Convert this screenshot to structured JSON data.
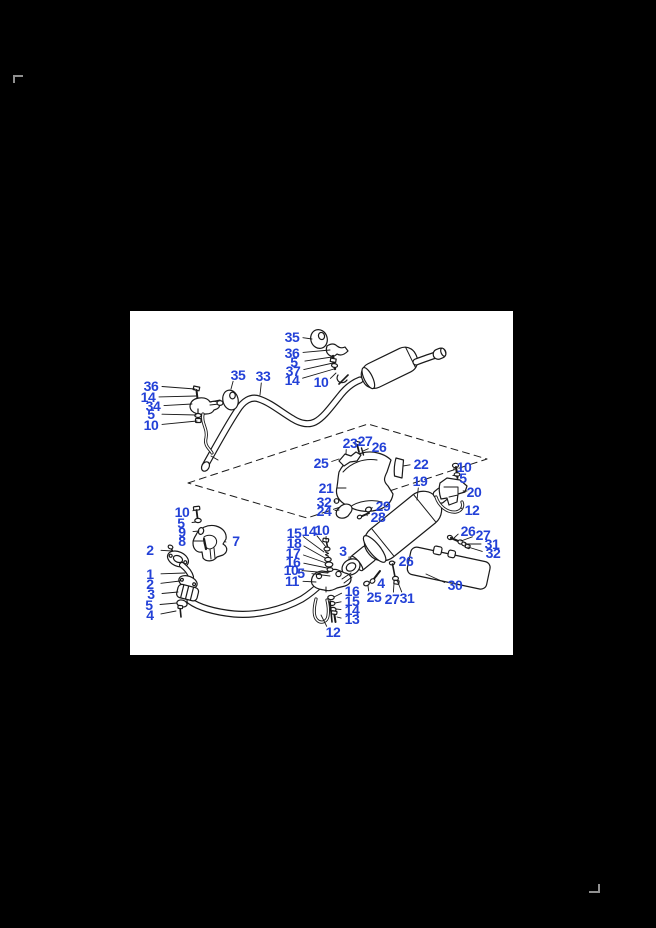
{
  "page": {
    "background_color": "#000000",
    "crop_mark_color": "#909090"
  },
  "panel": {
    "background_color": "#ffffff",
    "description_visible_text_only": "exploded parts diagram with numbered callouts"
  },
  "diagram": {
    "type": "exploded-parts-diagram",
    "line_color": "#1a1a1a",
    "label_color": "#2341d7",
    "callouts": [
      {
        "n": "35",
        "x": 162,
        "y": 26,
        "tx": 182,
        "ty": 28
      },
      {
        "n": "36",
        "x": 162,
        "y": 42,
        "tx": 200,
        "ty": 39
      },
      {
        "n": "5",
        "x": 164,
        "y": 51,
        "tx": 202,
        "ty": 46
      },
      {
        "n": "37",
        "x": 163,
        "y": 60,
        "tx": 203,
        "ty": 52
      },
      {
        "n": "14",
        "x": 162,
        "y": 69,
        "tx": 204,
        "ty": 58
      },
      {
        "n": "10",
        "x": 191,
        "y": 71,
        "tx": 206,
        "ty": 62
      },
      {
        "n": "35",
        "x": 108,
        "y": 64,
        "tx": 101,
        "ty": 78
      },
      {
        "n": "33",
        "x": 133,
        "y": 65,
        "tx": 130,
        "ty": 84
      },
      {
        "n": "36",
        "x": 21,
        "y": 75,
        "tx": 65,
        "ty": 78
      },
      {
        "n": "14",
        "x": 18,
        "y": 86,
        "tx": 66,
        "ty": 85
      },
      {
        "n": "34",
        "x": 23,
        "y": 95,
        "tx": 62,
        "ty": 93
      },
      {
        "n": "5",
        "x": 21,
        "y": 103,
        "tx": 66,
        "ty": 104
      },
      {
        "n": "10",
        "x": 21,
        "y": 114,
        "tx": 67,
        "ty": 110
      },
      {
        "n": "23",
        "x": 220,
        "y": 132,
        "tx": 216,
        "ty": 143
      },
      {
        "n": "27",
        "x": 235,
        "y": 130,
        "tx": 228,
        "ty": 135
      },
      {
        "n": "26",
        "x": 249,
        "y": 136,
        "tx": 233,
        "ty": 140
      },
      {
        "n": "25",
        "x": 191,
        "y": 152,
        "tx": 209,
        "ty": 148
      },
      {
        "n": "22",
        "x": 291,
        "y": 153,
        "tx": 273,
        "ty": 155
      },
      {
        "n": "10",
        "x": 334,
        "y": 156,
        "tx": 327,
        "ty": 158
      },
      {
        "n": "5",
        "x": 333,
        "y": 167,
        "tx": 328,
        "ty": 165
      },
      {
        "n": "21",
        "x": 196,
        "y": 177,
        "tx": 216,
        "ty": 177
      },
      {
        "n": "19",
        "x": 290,
        "y": 170,
        "tx": 287,
        "ty": 189
      },
      {
        "n": "20",
        "x": 344,
        "y": 181,
        "tx": 337,
        "ty": 180
      },
      {
        "n": "32",
        "x": 194,
        "y": 191,
        "tx": 205,
        "ty": 190
      },
      {
        "n": "24",
        "x": 194,
        "y": 200,
        "tx": 209,
        "ty": 199
      },
      {
        "n": "29",
        "x": 253,
        "y": 195,
        "tx": 241,
        "ty": 198
      },
      {
        "n": "28",
        "x": 248,
        "y": 206,
        "tx": 237,
        "ty": 204
      },
      {
        "n": "12",
        "x": 342,
        "y": 199,
        "tx": 332,
        "ty": 197
      },
      {
        "n": "10",
        "x": 52,
        "y": 201,
        "tx": 64,
        "ty": 199
      },
      {
        "n": "5",
        "x": 51,
        "y": 212,
        "tx": 66,
        "ty": 211
      },
      {
        "n": "9",
        "x": 52,
        "y": 221,
        "tx": 69,
        "ty": 220
      },
      {
        "n": "8",
        "x": 52,
        "y": 230,
        "tx": 73,
        "ty": 230
      },
      {
        "n": "7",
        "x": 106,
        "y": 230,
        "tx": 96,
        "ty": 231
      },
      {
        "n": "2",
        "x": 20,
        "y": 239,
        "tx": 42,
        "ty": 240
      },
      {
        "n": "1",
        "x": 20,
        "y": 263,
        "tx": 55,
        "ty": 262
      },
      {
        "n": "2",
        "x": 20,
        "y": 273,
        "tx": 50,
        "ty": 270
      },
      {
        "n": "3",
        "x": 21,
        "y": 283,
        "tx": 48,
        "ty": 281
      },
      {
        "n": "5",
        "x": 19,
        "y": 294,
        "tx": 47,
        "ty": 292
      },
      {
        "n": "4",
        "x": 20,
        "y": 304,
        "tx": 46,
        "ty": 300
      },
      {
        "n": "15",
        "x": 164,
        "y": 222,
        "tx": 194,
        "ty": 241
      },
      {
        "n": "14",
        "x": 179,
        "y": 220,
        "tx": 196,
        "ty": 236
      },
      {
        "n": "10",
        "x": 192,
        "y": 219,
        "tx": 196,
        "ty": 229
      },
      {
        "n": "18",
        "x": 164,
        "y": 232,
        "tx": 195,
        "ty": 247
      },
      {
        "n": "17",
        "x": 163,
        "y": 242,
        "tx": 196,
        "ty": 252
      },
      {
        "n": "16",
        "x": 163,
        "y": 251,
        "tx": 197,
        "ty": 257
      },
      {
        "n": "10",
        "x": 161,
        "y": 259,
        "tx": 198,
        "ty": 262
      },
      {
        "n": "5",
        "x": 171,
        "y": 262,
        "tx": 200,
        "ty": 265
      },
      {
        "n": "11",
        "x": 162,
        "y": 270,
        "tx": 186,
        "ty": 271
      },
      {
        "n": "3",
        "x": 213,
        "y": 240,
        "tx": 219,
        "ty": 249
      },
      {
        "n": "16",
        "x": 222,
        "y": 280,
        "tx": 204,
        "ty": 286
      },
      {
        "n": "15",
        "x": 222,
        "y": 290,
        "tx": 205,
        "ty": 292
      },
      {
        "n": "14",
        "x": 222,
        "y": 299,
        "tx": 206,
        "ty": 298
      },
      {
        "n": "13",
        "x": 222,
        "y": 308,
        "tx": 207,
        "ty": 306
      },
      {
        "n": "12",
        "x": 203,
        "y": 321,
        "tx": 191,
        "ty": 304
      },
      {
        "n": "4",
        "x": 251,
        "y": 272,
        "tx": 247,
        "ty": 265
      },
      {
        "n": "25",
        "x": 244,
        "y": 286,
        "tx": 238,
        "ty": 275
      },
      {
        "n": "27",
        "x": 262,
        "y": 288,
        "tx": 264,
        "ty": 272
      },
      {
        "n": "31",
        "x": 277,
        "y": 287,
        "tx": 267,
        "ty": 269
      },
      {
        "n": "26",
        "x": 276,
        "y": 250,
        "tx": 264,
        "ty": 252
      },
      {
        "n": "30",
        "x": 325,
        "y": 274,
        "tx": 296,
        "ty": 263
      },
      {
        "n": "26",
        "x": 338,
        "y": 220,
        "tx": 324,
        "ty": 227
      },
      {
        "n": "27",
        "x": 353,
        "y": 224,
        "tx": 331,
        "ty": 230
      },
      {
        "n": "31",
        "x": 362,
        "y": 233,
        "tx": 335,
        "ty": 233
      },
      {
        "n": "32",
        "x": 363,
        "y": 242,
        "tx": 338,
        "ty": 236
      }
    ]
  }
}
